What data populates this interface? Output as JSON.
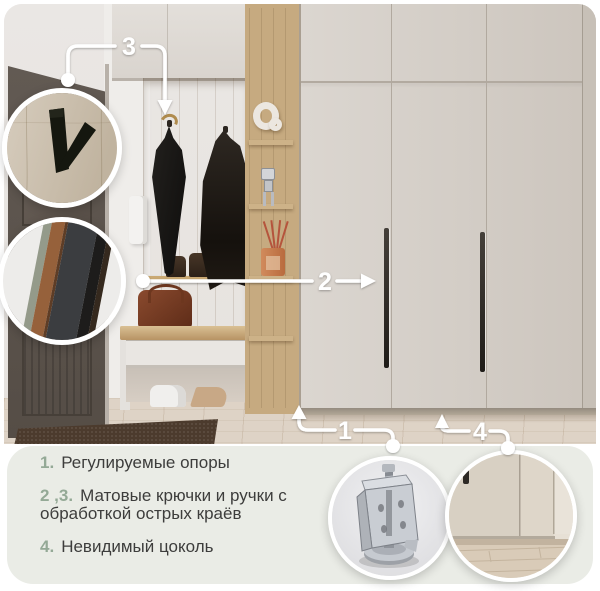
{
  "callouts": {
    "c1": "1",
    "c2": "2",
    "c3": "3",
    "c4": "4"
  },
  "legend": {
    "items": [
      {
        "num": "1.",
        "text": "Регулируемые опоры"
      },
      {
        "num": "2 ,3.",
        "text": "Матовые крючки и ручки с обработкой острых краёв"
      },
      {
        "num": "4.",
        "text": "Невидимый цоколь"
      }
    ]
  },
  "insets": [
    {
      "name": "matte-hook-closeup"
    },
    {
      "name": "handle-edge-closeup"
    },
    {
      "name": "adjustable-support-foot-closeup"
    },
    {
      "name": "invisible-plinth-closeup"
    }
  ],
  "colors": {
    "accent_green": "#94a996",
    "legend_text": "#3d3d3c",
    "legend_bg": "#eaece6",
    "callout_white": "#ffffff",
    "wardrobe_beige": "#d3cdc6",
    "oak_wood": "#b28f5e"
  }
}
